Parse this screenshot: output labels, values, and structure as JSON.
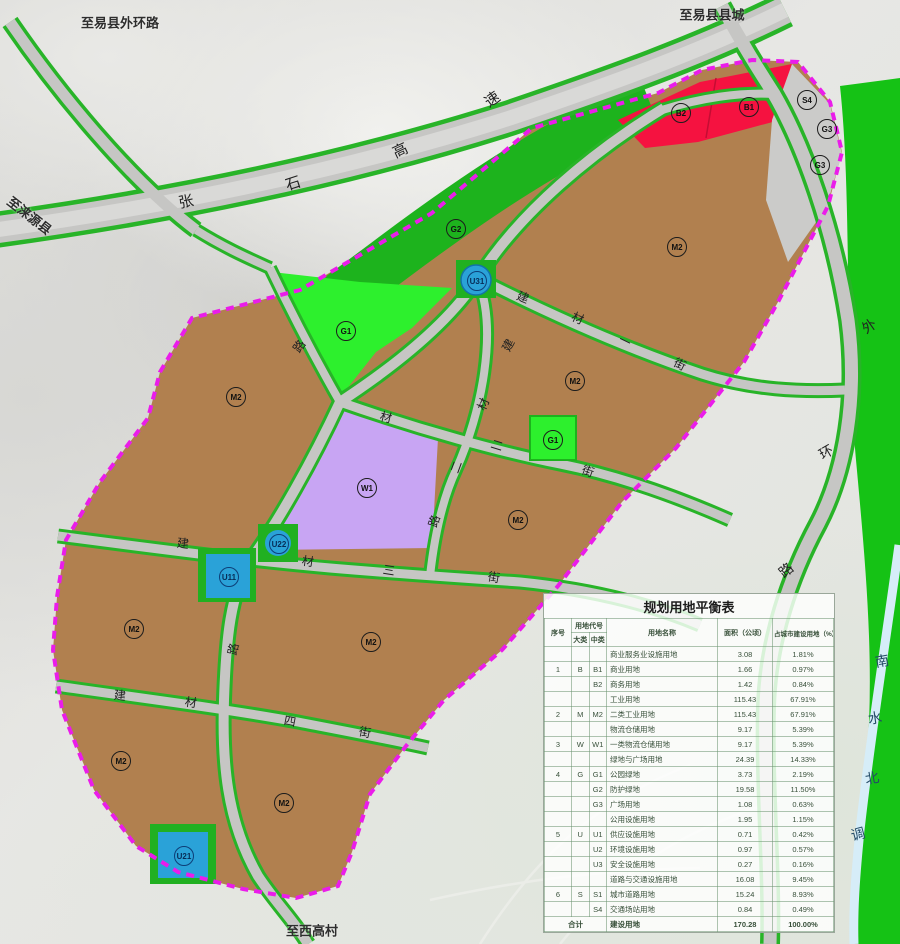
{
  "colors": {
    "boundary": "#ea1cea",
    "road_green_edge": "#28b428",
    "road_gray": "#c6c6c4",
    "highway_gray": "#cdcdcb",
    "zone_industrial_brown": "#b1804f",
    "zone_park_green_bright": "#2df02d",
    "zone_buffer_green": "#1db31d",
    "zone_logistics_purple": "#c8a5f3",
    "zone_commercial_red": "#f51240",
    "zone_utility_blue": "#2aa2d8",
    "zone_plaza_gray": "#cbcbc9",
    "canal_green": "#15c215",
    "canal_water": "#d6edf8"
  },
  "map": {
    "external_labels": [
      {
        "text": "至易县外环路",
        "x": 120,
        "y": 22,
        "rot": 0
      },
      {
        "text": "至易县县城",
        "x": 712,
        "y": 14,
        "rot": 0
      },
      {
        "text": "至涞源县",
        "x": 30,
        "y": 215,
        "rot": 38
      },
      {
        "text": "至西高村",
        "x": 312,
        "y": 930,
        "rot": 0
      }
    ],
    "road_chars": [
      {
        "ch": "张",
        "x": 186,
        "y": 201,
        "rot": -12,
        "size": 15
      },
      {
        "ch": "石",
        "x": 293,
        "y": 183,
        "rot": -18,
        "size": 15
      },
      {
        "ch": "高",
        "x": 400,
        "y": 150,
        "rot": -25,
        "size": 15
      },
      {
        "ch": "速",
        "x": 492,
        "y": 99,
        "rot": -35,
        "size": 15
      },
      {
        "ch": "建",
        "x": 523,
        "y": 297,
        "rot": 22
      },
      {
        "ch": "材",
        "x": 578,
        "y": 318,
        "rot": 24
      },
      {
        "ch": "一",
        "x": 625,
        "y": 341,
        "rot": 26
      },
      {
        "ch": "街",
        "x": 680,
        "y": 364,
        "rot": 27
      },
      {
        "ch": "建",
        "x": 508,
        "y": 345,
        "rot": -62
      },
      {
        "ch": "材",
        "x": 483,
        "y": 404,
        "rot": -66
      },
      {
        "ch": "二",
        "x": 456,
        "y": 467,
        "rot": -70
      },
      {
        "ch": "路",
        "x": 434,
        "y": 521,
        "rot": -72
      },
      {
        "ch": "材",
        "x": 386,
        "y": 417,
        "rot": 14
      },
      {
        "ch": "二",
        "x": 497,
        "y": 445,
        "rot": 17
      },
      {
        "ch": "街",
        "x": 588,
        "y": 471,
        "rot": 20
      },
      {
        "ch": "建",
        "x": 183,
        "y": 543,
        "rot": 7
      },
      {
        "ch": "材",
        "x": 308,
        "y": 561,
        "rot": 8
      },
      {
        "ch": "三",
        "x": 389,
        "y": 570,
        "rot": 9
      },
      {
        "ch": "街",
        "x": 494,
        "y": 577,
        "rot": 10
      },
      {
        "ch": "建",
        "x": 120,
        "y": 695,
        "rot": 6
      },
      {
        "ch": "材",
        "x": 191,
        "y": 702,
        "rot": 8
      },
      {
        "ch": "四",
        "x": 290,
        "y": 721,
        "rot": 11
      },
      {
        "ch": "街",
        "x": 365,
        "y": 732,
        "rot": 12
      },
      {
        "ch": "路",
        "x": 299,
        "y": 346,
        "rot": -55
      },
      {
        "ch": "路",
        "x": 233,
        "y": 649,
        "rot": -78
      },
      {
        "ch": "外",
        "x": 869,
        "y": 326,
        "rot": -35,
        "size": 14
      },
      {
        "ch": "环",
        "x": 826,
        "y": 452,
        "rot": -30,
        "size": 14
      },
      {
        "ch": "路",
        "x": 786,
        "y": 570,
        "rot": -40,
        "size": 14
      },
      {
        "ch": "南",
        "x": 882,
        "y": 661,
        "rot": -10,
        "size": 14,
        "cls": "water"
      },
      {
        "ch": "水",
        "x": 875,
        "y": 718,
        "rot": -8,
        "size": 14,
        "cls": "water"
      },
      {
        "ch": "北",
        "x": 872,
        "y": 778,
        "rot": -10,
        "size": 14,
        "cls": "water"
      },
      {
        "ch": "调",
        "x": 858,
        "y": 834,
        "rot": -15,
        "size": 14,
        "cls": "water"
      }
    ],
    "zone_labels": [
      {
        "code": "B2",
        "x": 680,
        "y": 112,
        "variant": "dark"
      },
      {
        "code": "B1",
        "x": 748,
        "y": 106,
        "variant": "dark"
      },
      {
        "code": "S4",
        "x": 806,
        "y": 99,
        "variant": "dark"
      },
      {
        "code": "G3",
        "x": 826,
        "y": 128,
        "variant": "dark"
      },
      {
        "code": "G3",
        "x": 819,
        "y": 164,
        "variant": "dark"
      },
      {
        "code": "G2",
        "x": 455,
        "y": 228,
        "variant": "dark"
      },
      {
        "code": "G1",
        "x": 345,
        "y": 330,
        "variant": "dark"
      },
      {
        "code": "M2",
        "x": 235,
        "y": 396,
        "variant": "dark"
      },
      {
        "code": "M2",
        "x": 676,
        "y": 246,
        "variant": "dark"
      },
      {
        "code": "M2",
        "x": 574,
        "y": 380,
        "variant": "dark"
      },
      {
        "code": "G1",
        "x": 552,
        "y": 439,
        "variant": "dark"
      },
      {
        "code": "M2",
        "x": 517,
        "y": 519,
        "variant": "dark"
      },
      {
        "code": "W1",
        "x": 366,
        "y": 487,
        "variant": "dark"
      },
      {
        "code": "U31",
        "x": 476,
        "y": 280,
        "variant": "blue"
      },
      {
        "code": "U22",
        "x": 278,
        "y": 543,
        "variant": "blue"
      },
      {
        "code": "U11",
        "x": 228,
        "y": 576,
        "variant": "blue"
      },
      {
        "code": "M2",
        "x": 133,
        "y": 628,
        "variant": "dark"
      },
      {
        "code": "M2",
        "x": 370,
        "y": 641,
        "variant": "dark"
      },
      {
        "code": "M2",
        "x": 120,
        "y": 760,
        "variant": "dark"
      },
      {
        "code": "M2",
        "x": 283,
        "y": 802,
        "variant": "dark"
      },
      {
        "code": "U21",
        "x": 183,
        "y": 855,
        "variant": "blue"
      }
    ]
  },
  "table": {
    "title": "规划用地平衡表",
    "headers": {
      "seq": "序号",
      "code": "用地代号",
      "major": "大类",
      "minor": "中类",
      "name": "用地名称",
      "area": "面积（公顷）",
      "pct": "占城市建设用地（%）"
    },
    "rows": [
      {
        "seq": "",
        "major": "",
        "minor": "",
        "name": "商业服务业设施用地",
        "area": "3.08",
        "pct": "1.81%"
      },
      {
        "seq": "1",
        "major": "B",
        "minor": "B1",
        "name": "商业用地",
        "area": "1.66",
        "pct": "0.97%"
      },
      {
        "seq": "",
        "major": "",
        "minor": "B2",
        "name": "商务用地",
        "area": "1.42",
        "pct": "0.84%"
      },
      {
        "seq": "",
        "major": "",
        "minor": "",
        "name": "工业用地",
        "area": "115.43",
        "pct": "67.91%"
      },
      {
        "seq": "2",
        "major": "M",
        "minor": "M2",
        "name": "二类工业用地",
        "area": "115.43",
        "pct": "67.91%"
      },
      {
        "seq": "",
        "major": "",
        "minor": "",
        "name": "物流仓储用地",
        "area": "9.17",
        "pct": "5.39%"
      },
      {
        "seq": "3",
        "major": "W",
        "minor": "W1",
        "name": "一类物流仓储用地",
        "area": "9.17",
        "pct": "5.39%"
      },
      {
        "seq": "",
        "major": "",
        "minor": "",
        "name": "绿地与广场用地",
        "area": "24.39",
        "pct": "14.33%"
      },
      {
        "seq": "4",
        "major": "G",
        "minor": "G1",
        "name": "公园绿地",
        "area": "3.73",
        "pct": "2.19%"
      },
      {
        "seq": "",
        "major": "",
        "minor": "G2",
        "name": "防护绿地",
        "area": "19.58",
        "pct": "11.50%"
      },
      {
        "seq": "",
        "major": "",
        "minor": "G3",
        "name": "广场用地",
        "area": "1.08",
        "pct": "0.63%"
      },
      {
        "seq": "",
        "major": "",
        "minor": "",
        "name": "公用设施用地",
        "area": "1.95",
        "pct": "1.15%"
      },
      {
        "seq": "5",
        "major": "U",
        "minor": "U1",
        "name": "供应设施用地",
        "area": "0.71",
        "pct": "0.42%"
      },
      {
        "seq": "",
        "major": "",
        "minor": "U2",
        "name": "环境设施用地",
        "area": "0.97",
        "pct": "0.57%"
      },
      {
        "seq": "",
        "major": "",
        "minor": "U3",
        "name": "安全设施用地",
        "area": "0.27",
        "pct": "0.16%"
      },
      {
        "seq": "",
        "major": "",
        "minor": "",
        "name": "道路与交通设施用地",
        "area": "16.08",
        "pct": "9.45%"
      },
      {
        "seq": "6",
        "major": "S",
        "minor": "S1",
        "name": "城市道路用地",
        "area": "15.24",
        "pct": "8.93%"
      },
      {
        "seq": "",
        "major": "",
        "minor": "S4",
        "name": "交通场站用地",
        "area": "0.84",
        "pct": "0.49%"
      }
    ],
    "footer": {
      "seq": "合计",
      "name": "建设用地",
      "area": "170.28",
      "pct": "100.00%"
    }
  }
}
